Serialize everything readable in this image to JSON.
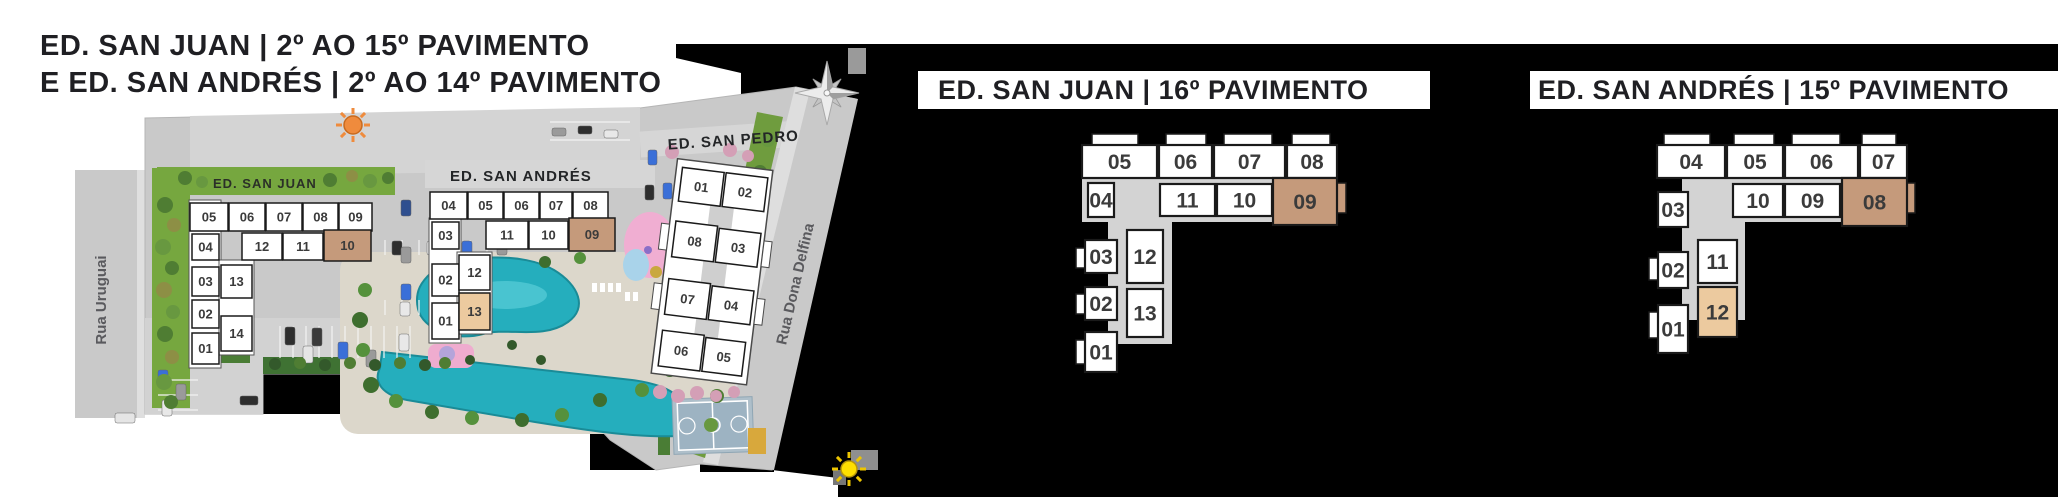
{
  "colors": {
    "page_bg": "#ffffff",
    "panel_bg": "#000000",
    "title_text": "#1f1f23",
    "unit_fill": "#ffffff",
    "unit_border": "#1a1a1a",
    "unit_text": "#3b3b3b",
    "highlight_dark": "#c59a7b",
    "highlight_light": "#ecca9f",
    "corridor": "#d3d3d3",
    "street": "#c9c9c9",
    "grass": "#76a73f",
    "pool": "#25aebd",
    "court": "#9db3c2",
    "sun_orange": "#ef8b3d",
    "sun_yellow": "#ffdf00"
  },
  "header": {
    "line1": "ED. SAN JUAN | 2º AO 15º PAVIMENTO",
    "line2": "E ED. SAN ANDRÉS | 2º AO 14º PAVIMENTO"
  },
  "site_plan": {
    "streets": [
      {
        "name": "Rua Uruguai"
      },
      {
        "name": "Rua Dona Delfina"
      }
    ],
    "icons": [
      "sun-icon-orange",
      "sun-icon-yellow",
      "compass-rose-icon"
    ],
    "buildings": [
      {
        "label": "ED. SAN JUAN",
        "units": [
          {
            "n": "05",
            "x": 190,
            "y": 203,
            "w": 38,
            "h": 28,
            "hl": ""
          },
          {
            "n": "06",
            "x": 229,
            "y": 203,
            "w": 36,
            "h": 28,
            "hl": ""
          },
          {
            "n": "07",
            "x": 266,
            "y": 203,
            "w": 36,
            "h": 28,
            "hl": ""
          },
          {
            "n": "08",
            "x": 303,
            "y": 203,
            "w": 35,
            "h": 28,
            "hl": ""
          },
          {
            "n": "09",
            "x": 339,
            "y": 203,
            "w": 33,
            "h": 28,
            "hl": ""
          },
          {
            "n": "04",
            "x": 192,
            "y": 234,
            "w": 27,
            "h": 26,
            "hl": ""
          },
          {
            "n": "12",
            "x": 242,
            "y": 233,
            "w": 40,
            "h": 27,
            "hl": ""
          },
          {
            "n": "11",
            "x": 283,
            "y": 233,
            "w": 40,
            "h": 27,
            "hl": ""
          },
          {
            "n": "10",
            "x": 324,
            "y": 230,
            "w": 47,
            "h": 31,
            "hl": "dark"
          },
          {
            "n": "03",
            "x": 192,
            "y": 267,
            "w": 27,
            "h": 29,
            "hl": ""
          },
          {
            "n": "02",
            "x": 192,
            "y": 300,
            "w": 27,
            "h": 28,
            "hl": ""
          },
          {
            "n": "01",
            "x": 192,
            "y": 333,
            "w": 27,
            "h": 31,
            "hl": ""
          },
          {
            "n": "13",
            "x": 221,
            "y": 265,
            "w": 31,
            "h": 33,
            "hl": ""
          },
          {
            "n": "14",
            "x": 221,
            "y": 316,
            "w": 31,
            "h": 35,
            "hl": ""
          }
        ]
      },
      {
        "label": "ED. SAN ANDRÉS",
        "units": [
          {
            "n": "04",
            "x": 430,
            "y": 192,
            "w": 37,
            "h": 27,
            "hl": ""
          },
          {
            "n": "05",
            "x": 468,
            "y": 192,
            "w": 35,
            "h": 27,
            "hl": ""
          },
          {
            "n": "06",
            "x": 504,
            "y": 192,
            "w": 35,
            "h": 27,
            "hl": ""
          },
          {
            "n": "07",
            "x": 540,
            "y": 192,
            "w": 32,
            "h": 27,
            "hl": ""
          },
          {
            "n": "08",
            "x": 573,
            "y": 192,
            "w": 35,
            "h": 27,
            "hl": ""
          },
          {
            "n": "03",
            "x": 432,
            "y": 222,
            "w": 27,
            "h": 27,
            "hl": ""
          },
          {
            "n": "11",
            "x": 486,
            "y": 221,
            "w": 42,
            "h": 28,
            "hl": ""
          },
          {
            "n": "10",
            "x": 529,
            "y": 221,
            "w": 39,
            "h": 28,
            "hl": ""
          },
          {
            "n": "09",
            "x": 569,
            "y": 218,
            "w": 46,
            "h": 33,
            "hl": "dark"
          },
          {
            "n": "02",
            "x": 432,
            "y": 264,
            "w": 27,
            "h": 32,
            "hl": ""
          },
          {
            "n": "01",
            "x": 432,
            "y": 303,
            "w": 27,
            "h": 36,
            "hl": ""
          },
          {
            "n": "12",
            "x": 459,
            "y": 255,
            "w": 31,
            "h": 35,
            "hl": ""
          },
          {
            "n": "13",
            "x": 459,
            "y": 293,
            "w": 31,
            "h": 37,
            "hl": "light"
          }
        ]
      },
      {
        "label": "ED. SAN PEDRO",
        "units": [
          {
            "n": "01",
            "x": 670,
            "y": 172,
            "w": 42,
            "h": 34,
            "hl": ""
          },
          {
            "n": "02",
            "x": 714,
            "y": 172,
            "w": 42,
            "h": 34,
            "hl": ""
          },
          {
            "n": "08",
            "x": 670,
            "y": 226,
            "w": 42,
            "h": 36,
            "hl": ""
          },
          {
            "n": "03",
            "x": 714,
            "y": 228,
            "w": 42,
            "h": 34,
            "hl": ""
          },
          {
            "n": "07",
            "x": 670,
            "y": 284,
            "w": 42,
            "h": 36,
            "hl": ""
          },
          {
            "n": "04",
            "x": 714,
            "y": 286,
            "w": 42,
            "h": 34,
            "hl": ""
          },
          {
            "n": "06",
            "x": 670,
            "y": 336,
            "w": 42,
            "h": 36,
            "hl": ""
          },
          {
            "n": "05",
            "x": 714,
            "y": 338,
            "w": 40,
            "h": 34,
            "hl": ""
          }
        ]
      }
    ]
  },
  "floor_plans": [
    {
      "title": "ED. SAN JUAN | 16º PAVIMENTO",
      "units": [
        {
          "n": "05",
          "x": 1082,
          "y": 145,
          "w": 75,
          "h": 33,
          "hl": ""
        },
        {
          "n": "06",
          "x": 1159,
          "y": 145,
          "w": 53,
          "h": 33,
          "hl": ""
        },
        {
          "n": "07",
          "x": 1214,
          "y": 145,
          "w": 71,
          "h": 33,
          "hl": ""
        },
        {
          "n": "08",
          "x": 1287,
          "y": 145,
          "w": 50,
          "h": 33,
          "hl": ""
        },
        {
          "n": "04",
          "x": 1088,
          "y": 183,
          "w": 26,
          "h": 34,
          "hl": ""
        },
        {
          "n": "11",
          "x": 1160,
          "y": 184,
          "w": 55,
          "h": 32,
          "hl": ""
        },
        {
          "n": "10",
          "x": 1217,
          "y": 184,
          "w": 55,
          "h": 32,
          "hl": ""
        },
        {
          "n": "09",
          "x": 1273,
          "y": 178,
          "w": 64,
          "h": 47,
          "hl": "dark"
        },
        {
          "n": "03",
          "x": 1085,
          "y": 240,
          "w": 32,
          "h": 33,
          "hl": ""
        },
        {
          "n": "02",
          "x": 1085,
          "y": 287,
          "w": 32,
          "h": 33,
          "hl": ""
        },
        {
          "n": "01",
          "x": 1085,
          "y": 332,
          "w": 32,
          "h": 40,
          "hl": ""
        },
        {
          "n": "12",
          "x": 1127,
          "y": 230,
          "w": 36,
          "h": 53,
          "hl": ""
        },
        {
          "n": "13",
          "x": 1127,
          "y": 289,
          "w": 36,
          "h": 48,
          "hl": ""
        }
      ]
    },
    {
      "title": "ED. SAN ANDRÉS | 15º PAVIMENTO",
      "units": [
        {
          "n": "04",
          "x": 1657,
          "y": 145,
          "w": 68,
          "h": 33,
          "hl": ""
        },
        {
          "n": "05",
          "x": 1727,
          "y": 145,
          "w": 56,
          "h": 33,
          "hl": ""
        },
        {
          "n": "06",
          "x": 1785,
          "y": 145,
          "w": 73,
          "h": 33,
          "hl": ""
        },
        {
          "n": "07",
          "x": 1860,
          "y": 145,
          "w": 47,
          "h": 33,
          "hl": ""
        },
        {
          "n": "03",
          "x": 1658,
          "y": 192,
          "w": 30,
          "h": 35,
          "hl": ""
        },
        {
          "n": "10",
          "x": 1733,
          "y": 184,
          "w": 50,
          "h": 33,
          "hl": ""
        },
        {
          "n": "09",
          "x": 1785,
          "y": 184,
          "w": 55,
          "h": 33,
          "hl": ""
        },
        {
          "n": "08",
          "x": 1842,
          "y": 178,
          "w": 65,
          "h": 48,
          "hl": "dark"
        },
        {
          "n": "02",
          "x": 1658,
          "y": 252,
          "w": 30,
          "h": 36,
          "hl": ""
        },
        {
          "n": "01",
          "x": 1658,
          "y": 305,
          "w": 30,
          "h": 48,
          "hl": ""
        },
        {
          "n": "11",
          "x": 1698,
          "y": 240,
          "w": 39,
          "h": 43,
          "hl": ""
        },
        {
          "n": "12",
          "x": 1698,
          "y": 287,
          "w": 39,
          "h": 50,
          "hl": "light"
        }
      ]
    }
  ]
}
